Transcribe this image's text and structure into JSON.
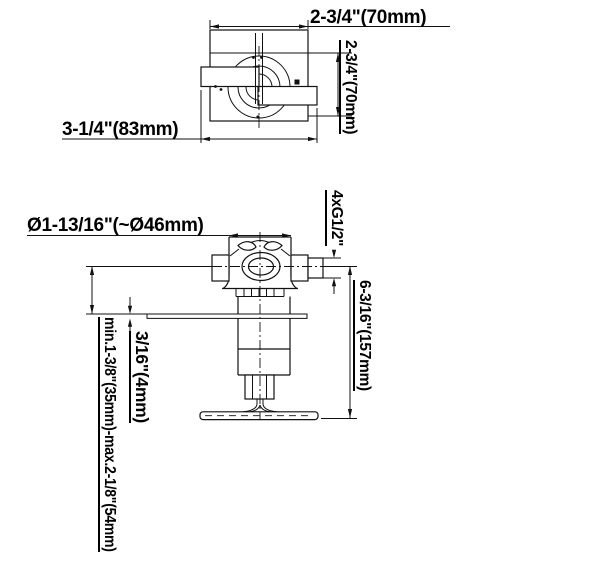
{
  "drawing": {
    "type": "technical-dimension-drawing",
    "line_color": "#111111",
    "background": "#ffffff",
    "top_view": {
      "dim_width_top": "2-3/4\"(70mm)",
      "dim_height_right": "2-3/4\"(70mm)",
      "dim_width_bottom": "3-1/4\"(83mm)"
    },
    "front_view": {
      "dim_valve_diameter": "Ø1-13/16\"(~Ø46mm)",
      "dim_connections": "4xG1/2\"",
      "dim_total_height": "6-3/16\"(157mm)",
      "dim_mounting_depth_range": "min.1-3/8\"(35mm)-max.2-1/8\"(54mm)",
      "dim_plate_thickness": "3/16\"(4mm)"
    }
  }
}
